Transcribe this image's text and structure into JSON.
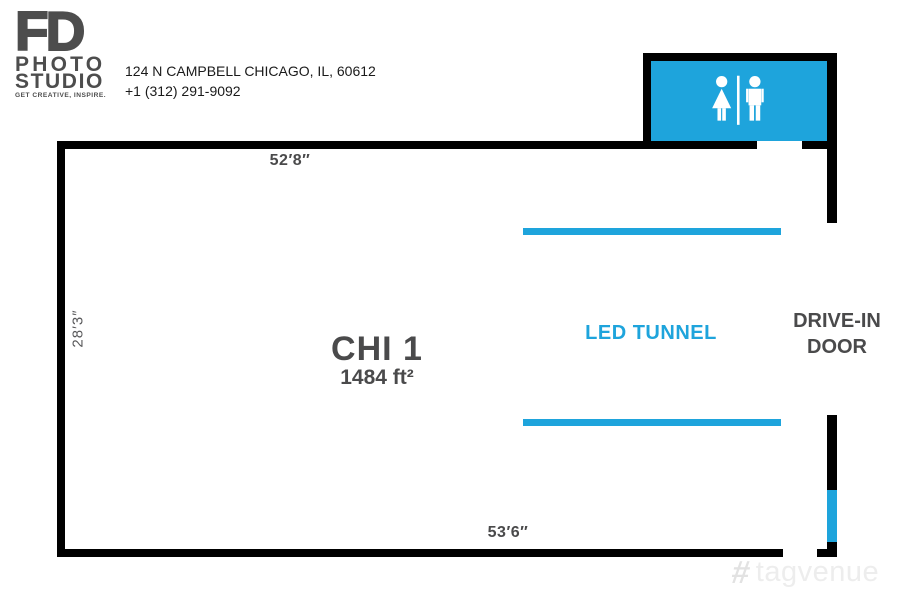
{
  "brand": {
    "logo": {
      "fd": "FD",
      "photo": "PHOTO",
      "studio": "STUDIO",
      "tagline": "GET CREATIVE, INSPIRE."
    },
    "address_line1": "124 N CAMPBELL CHICAGO, IL, 60612",
    "phone": "+1 (312) 291-9092"
  },
  "floorplan": {
    "room_name": "CHI 1",
    "room_area": "1484 ft²",
    "dimensions": {
      "top": "52′8″",
      "left": "28′3″",
      "bottom": "53′6″"
    },
    "labels": {
      "led_tunnel": "LED TUNNEL",
      "drive_in_line1": "DRIVE-IN",
      "drive_in_line2": "DOOR"
    },
    "features": [
      "restroom",
      "led-tunnel",
      "drive-in-door"
    ]
  },
  "colors": {
    "accent_blue": "#1EA4DC",
    "wall": "#000000",
    "label_gray": "#4A4A4B",
    "logo_gray": "#4D4D4D",
    "address_text": "#1A1A1A",
    "watermark_gray": "#EDEDED"
  },
  "watermark": {
    "text": "tagvenue",
    "icon": "hashtag-icon"
  }
}
